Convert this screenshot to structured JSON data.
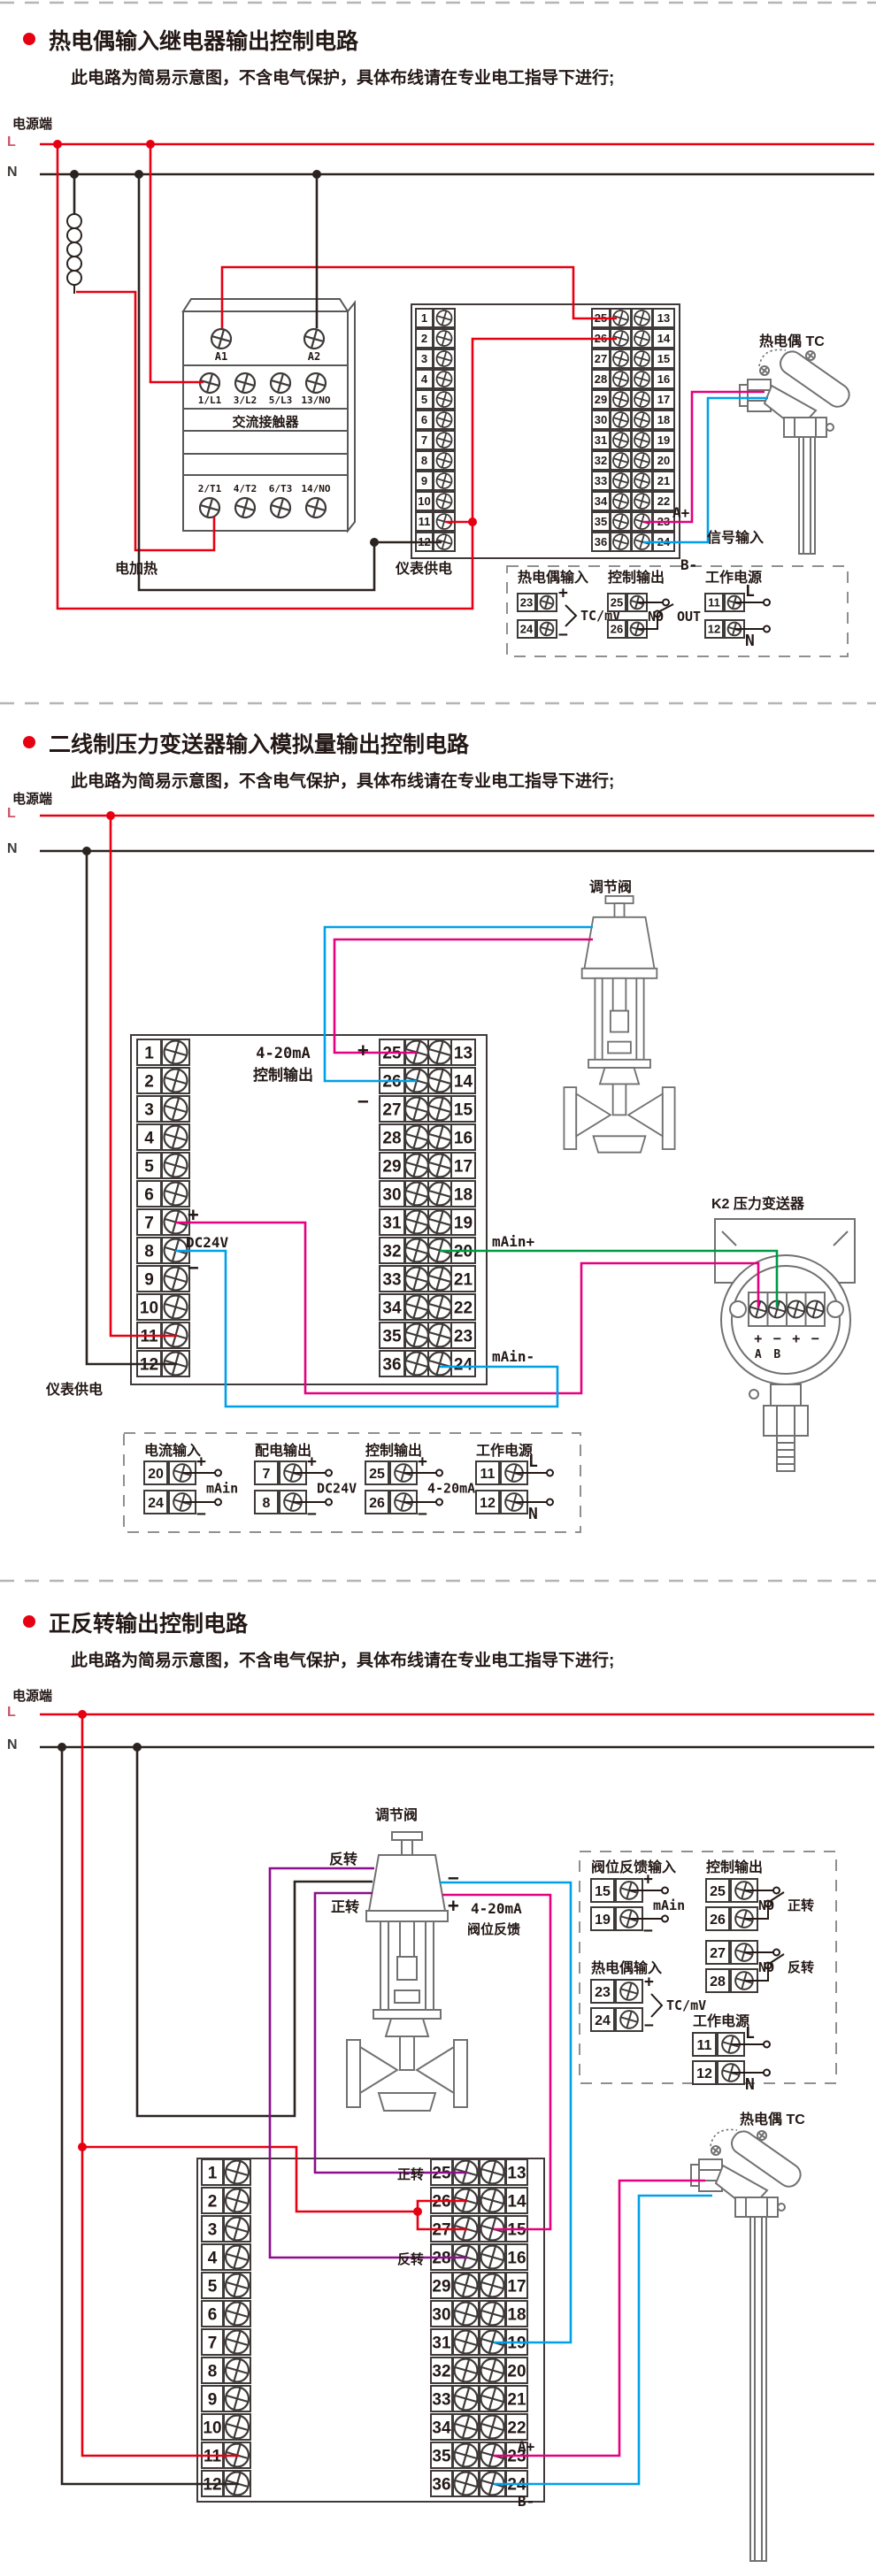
{
  "colors": {
    "red": "#e60012",
    "blk": "#2b2320",
    "mag": "#e4007f",
    "cyn": "#00a0e9",
    "grn": "#009944",
    "pur": "#8c0f8c",
    "softred": "#c9566b"
  },
  "sections": [
    {
      "title": "热电偶输入继电器输出控制电路",
      "subtitle": "此电路为简易示意图，不含电气保护，具体布线请在专业电工指导下进行;",
      "power": "电源端",
      "l": "L",
      "n": "N"
    },
    {
      "title": "二线制压力变送器输入模拟量输出控制电路",
      "subtitle": "此电路为简易示意图，不含电气保护，具体布线请在专业电工指导下进行;",
      "power": "电源端",
      "l": "L",
      "n": "N"
    },
    {
      "title": "正反转输出控制电路",
      "subtitle": "此电路为简易示意图，不含电气保护，具体布线请在专业电工指导下进行;",
      "power": "电源端",
      "l": "L",
      "n": "N"
    }
  ],
  "strips": {
    "s1": {
      "left": [
        1,
        2,
        3,
        4,
        5,
        6,
        7,
        8,
        9,
        10,
        11,
        12
      ],
      "mid": [
        25,
        26,
        27,
        28,
        29,
        30,
        31,
        32,
        33,
        34,
        35,
        36
      ],
      "right": [
        13,
        14,
        15,
        16,
        17,
        18,
        19,
        20,
        21,
        22,
        23,
        24
      ]
    },
    "s2": {
      "left": [
        1,
        2,
        3,
        4,
        5,
        6,
        7,
        8,
        9,
        10,
        11,
        12
      ],
      "mid": [
        25,
        26,
        27,
        28,
        29,
        30,
        31,
        32,
        33,
        34,
        35,
        36
      ],
      "right": [
        13,
        14,
        15,
        16,
        17,
        18,
        19,
        20,
        21,
        22,
        23,
        24
      ]
    },
    "s3": {
      "left": [
        1,
        2,
        3,
        4,
        5,
        6,
        7,
        8,
        9,
        10,
        11,
        12
      ],
      "mid": [
        25,
        26,
        27,
        28,
        29,
        30,
        31,
        32,
        33,
        34,
        35,
        36
      ],
      "right": [
        13,
        14,
        15,
        16,
        17,
        18,
        19,
        20,
        21,
        22,
        23,
        24
      ]
    }
  },
  "contactor": {
    "name": "交流接触器",
    "coil": [
      "A1",
      "A2"
    ],
    "top": [
      "1/L1",
      "3/L2",
      "5/L3",
      "13/NO"
    ],
    "bottom": [
      "2/T1",
      "4/T2",
      "6/T3",
      "14/NO"
    ]
  },
  "transmitter": {
    "label": "K2 压力变送器",
    "signs": [
      "+",
      "−",
      "+",
      "−"
    ],
    "letters": [
      "A",
      "B"
    ]
  },
  "labels": {
    "s1-heater": "电加热",
    "s1-meter-supply": "仪表供电",
    "s1-tc": "热电偶 TC",
    "s1-signal": "信号输入",
    "s1-a-plus": "A+",
    "s1-b-minus": "B-",
    "s2-valve": "调节阀",
    "s2-out1": "4-20mA",
    "s2-out2": "控制输出",
    "s2-plus": "+",
    "s2-minus": "−",
    "s2-dc-plus": "+",
    "s2-dc": "DC24V",
    "s2-dc-minus": "−",
    "s2-k2": "K2 压力变送器",
    "s2-main-plus": "mAin+",
    "s2-main-minus": "mAin-",
    "s2-meter-supply": "仪表供电",
    "s3-valve": "调节阀",
    "s3-rev": "反转",
    "s3-fwd": "正转",
    "s3-minus": "−",
    "s3-plus": "+",
    "s3-fb1": "4-20mA",
    "s3-fb2": "阀位反馈",
    "s3-fwd2": "正转",
    "s3-rev2": "反转",
    "s3-a-plus": "A+",
    "s3-b-minus": "B-",
    "s3-tc": "热电偶 TC"
  },
  "legends": [
    {
      "items": [
        {
          "title": "热电偶输入",
          "pairs": [
            {
              "nums": [
                "23",
                "24"
              ],
              "signs": [
                "+",
                "−"
              ],
              "style": "bracket",
              "tail": "TC/mV"
            }
          ]
        },
        {
          "title": "控制输出",
          "pairs": [
            {
              "nums": [
                "25",
                "26"
              ],
              "style": "switch",
              "tag": "NO",
              "tail": "OUT"
            }
          ]
        },
        {
          "title": "工作电源",
          "pairs": [
            {
              "nums": [
                "11",
                "12"
              ],
              "signs": [
                "L",
                "N"
              ],
              "style": "circles"
            }
          ]
        }
      ]
    },
    {
      "items": [
        {
          "title": "电流输入",
          "pairs": [
            {
              "nums": [
                "20",
                "24"
              ],
              "signs": [
                "+",
                "−"
              ],
              "style": "circles",
              "tail": "mAin"
            }
          ]
        },
        {
          "title": "配电输出",
          "pairs": [
            {
              "nums": [
                "7",
                "8"
              ],
              "signs": [
                "+",
                "−"
              ],
              "style": "circles",
              "tail": "DC24V"
            }
          ]
        },
        {
          "title": "控制输出",
          "pairs": [
            {
              "nums": [
                "25",
                "26"
              ],
              "signs": [
                "+",
                "−"
              ],
              "style": "circles",
              "tail": "4-20mA"
            }
          ]
        },
        {
          "title": "工作电源",
          "pairs": [
            {
              "nums": [
                "11",
                "12"
              ],
              "signs": [
                "L",
                "N"
              ],
              "style": "circles"
            }
          ]
        }
      ]
    },
    {
      "items": [
        {
          "title": "阀位反馈输入",
          "pairs": [
            {
              "nums": [
                "15",
                "19"
              ],
              "signs": [
                "+",
                "−"
              ],
              "style": "circles",
              "tail": "mAin"
            }
          ]
        },
        {
          "title": "控制输出",
          "pairs": [
            {
              "nums": [
                "25",
                "26"
              ],
              "style": "switch",
              "tag": "NO",
              "tail": "正转"
            },
            {
              "nums": [
                "27",
                "28"
              ],
              "style": "switch",
              "tag": "NO",
              "tail": "反转"
            }
          ]
        },
        {
          "title": "热电偶输入",
          "pairs": [
            {
              "nums": [
                "23",
                "24"
              ],
              "signs": [
                "+",
                "−"
              ],
              "style": "bracket",
              "tail": "TC/mV"
            }
          ]
        },
        {
          "title": "工作电源",
          "pairs": [
            {
              "nums": [
                "11",
                "12"
              ],
              "signs": [
                "L",
                "N"
              ],
              "style": "circles"
            }
          ]
        }
      ]
    }
  ]
}
